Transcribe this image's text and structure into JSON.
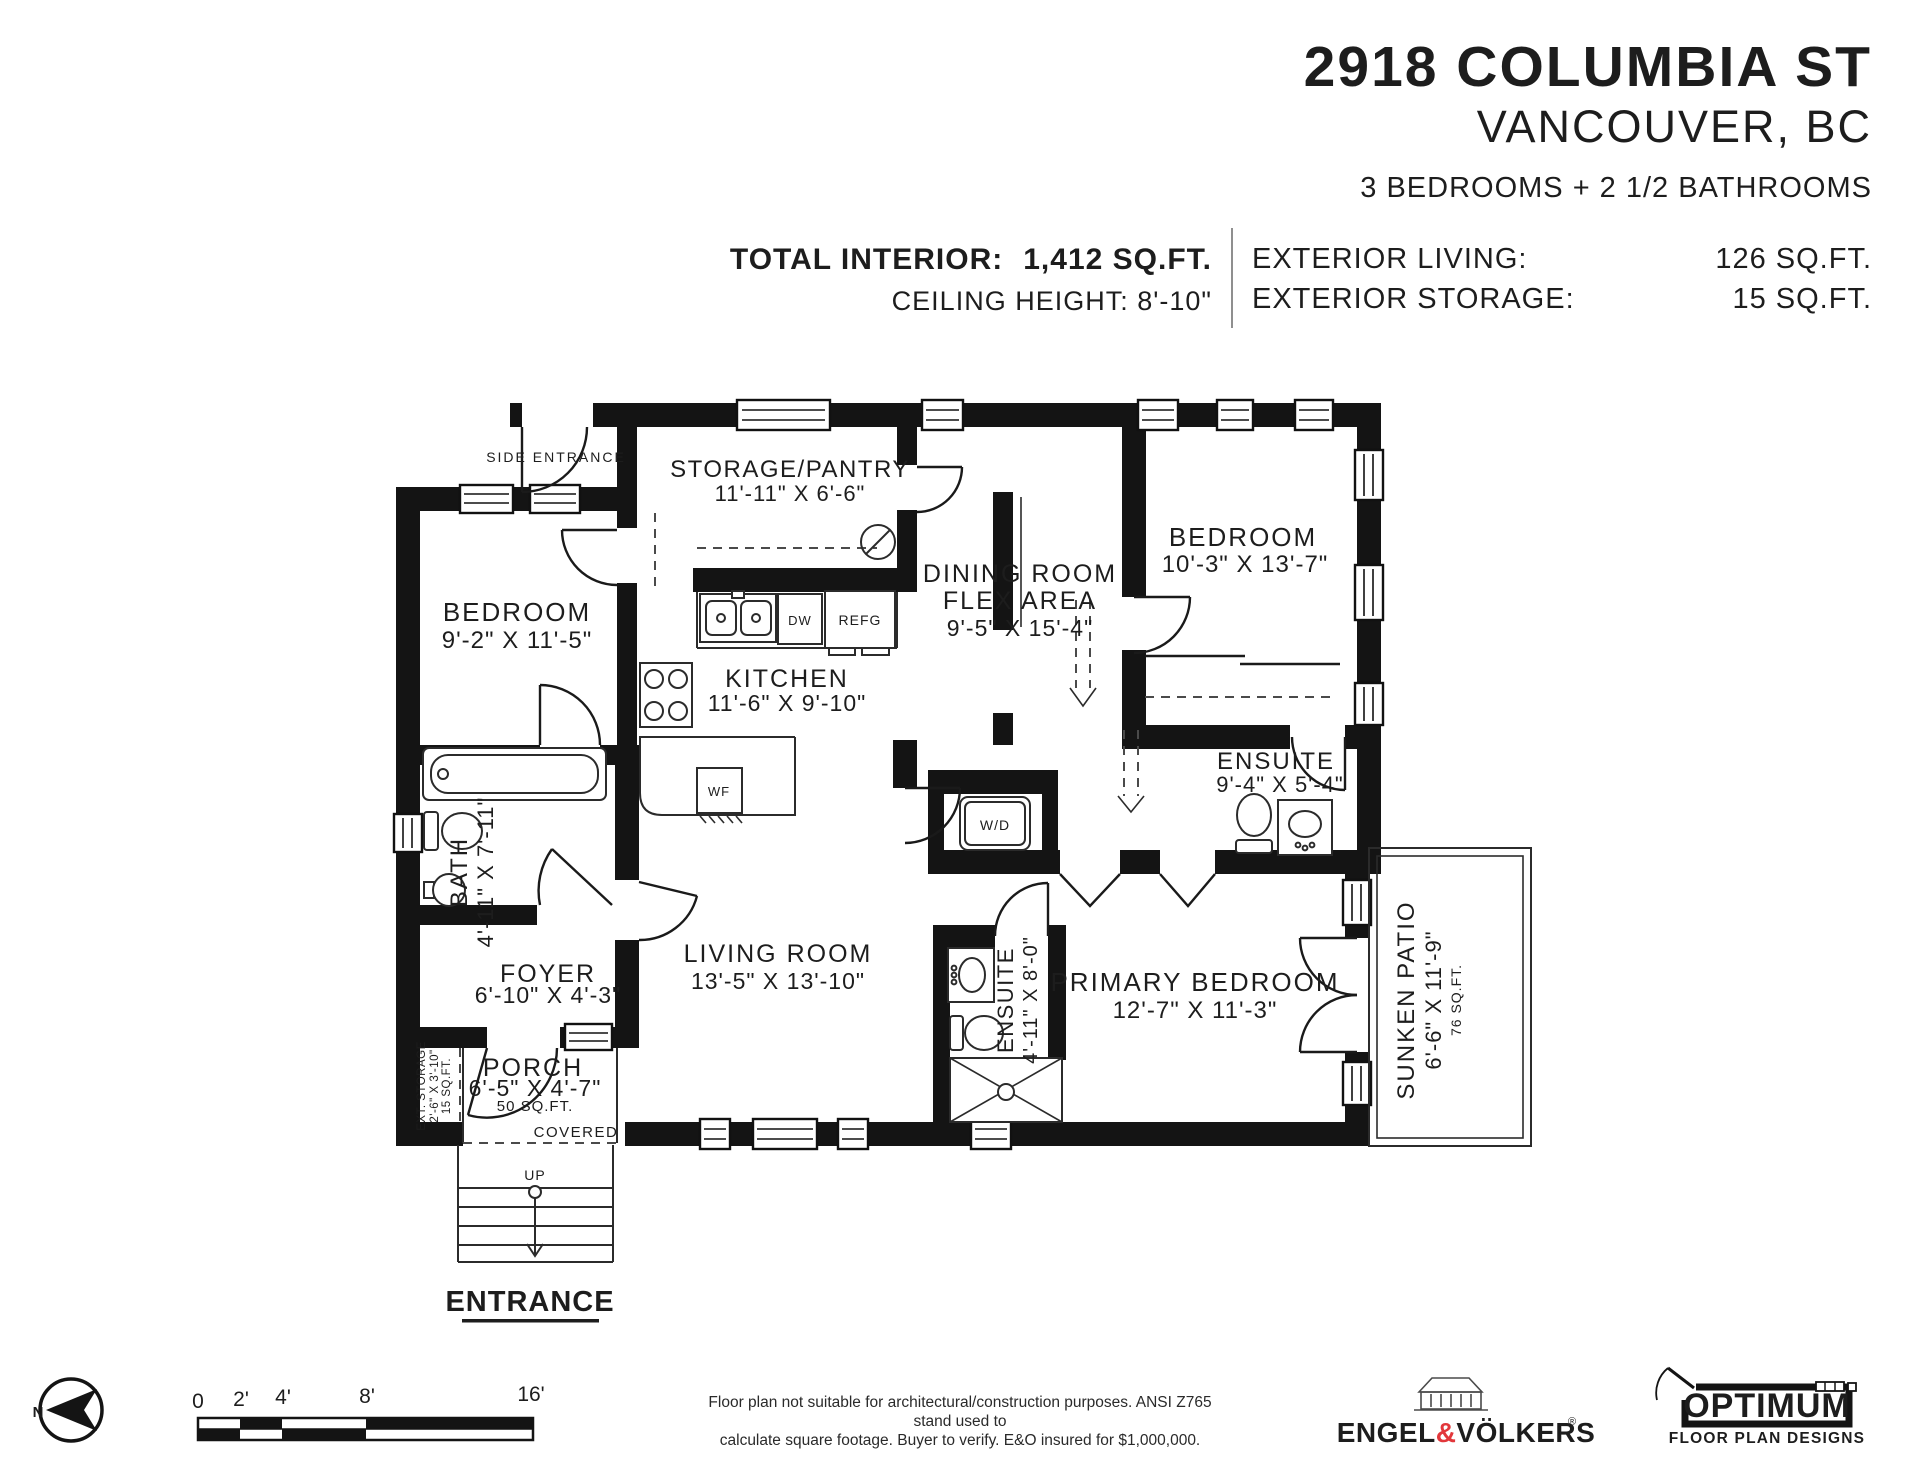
{
  "header": {
    "address": "2918 COLUMBIA ST",
    "city": "VANCOUVER, BC",
    "summary": "3 BEDROOMS + 2 1/2 BATHROOMS",
    "total_interior_label": "TOTAL INTERIOR:",
    "total_interior_value": "1,412 SQ.FT.",
    "ceiling_height": "CEILING HEIGHT: 8'-10\"",
    "exterior_living_label": "EXTERIOR LIVING:",
    "exterior_living_value": "126 SQ.FT.",
    "exterior_storage_label": "EXTERIOR STORAGE:",
    "exterior_storage_value": "15 SQ.FT."
  },
  "rooms": {
    "storage_pantry": {
      "name": "STORAGE/PANTRY",
      "dims": "11'-11\" X 6'-6\""
    },
    "bedroom_left": {
      "name": "BEDROOM",
      "dims": "9'-2\" X 11'-5\""
    },
    "kitchen": {
      "name": "KITCHEN",
      "dims": "11'-6\" X 9'-10\""
    },
    "dining": {
      "name": "DINING ROOM",
      "name2": "FLEX AREA",
      "dims": "9'-5\" X 15'-4\""
    },
    "bedroom_right": {
      "name": "BEDROOM",
      "dims": "10'-3\" X 13'-7\""
    },
    "ensuite_right": {
      "name": "ENSUITE",
      "dims": "9'-4\" X 5'-4\""
    },
    "bath": {
      "name": "BATH",
      "dims": "4'-11\" X 7'-11\""
    },
    "living": {
      "name": "LIVING ROOM",
      "dims": "13'-5\" X 13'-10\""
    },
    "foyer": {
      "name": "FOYER",
      "dims": "6'-10\" X 4'-3\""
    },
    "porch": {
      "name": "PORCH",
      "dims": "6'-5\" X 4'-7\"",
      "area": "50 SQ.FT.",
      "covered": "COVERED"
    },
    "ensuite_primary": {
      "name": "ENSUITE",
      "dims": "4'-11\" X 8'-0\""
    },
    "primary_bedroom": {
      "name": "PRIMARY BEDROOM",
      "dims": "12'-7\" X 11'-3\""
    },
    "sunken_patio": {
      "name": "SUNKEN PATIO",
      "dims": "6'-6\" X 11'-9\"",
      "area": "76 SQ.FT."
    },
    "ext_storage": {
      "line1": "EXT. STORAGE",
      "line2": "2'-6\" X 3'-10\"",
      "line3": "15 SQ.FT."
    }
  },
  "annotations": {
    "side_entrance": "SIDE ENTRANCE",
    "entrance": "ENTRANCE",
    "up": "UP",
    "appliances": {
      "dw": "DW",
      "refg": "REFG",
      "wf": "WF",
      "wd": "W/D"
    }
  },
  "scale_bar": {
    "labels": [
      "0",
      "2'",
      "4'",
      "8'",
      "16'"
    ]
  },
  "footer": {
    "north_letter": "N",
    "disclaimer_line1": "Floor plan not suitable for architectural/construction purposes. ANSI Z765 stand used to",
    "disclaimer_line2": "calculate square footage. Buyer to verify.  E&O insured for $1,000,000.",
    "brand_engel": "ENGEL",
    "brand_amp": "&",
    "brand_volkers": "VÖLKERS",
    "reg": "®",
    "optimum_title": "OPTIMUM",
    "optimum_subtitle": "FLOOR PLAN DESIGNS"
  },
  "colors": {
    "wall": "#141414",
    "text": "#1d1d1d",
    "accent_red": "#e2373b",
    "thin_line": "#2b2b2b",
    "divider": "#8f8f8f"
  }
}
